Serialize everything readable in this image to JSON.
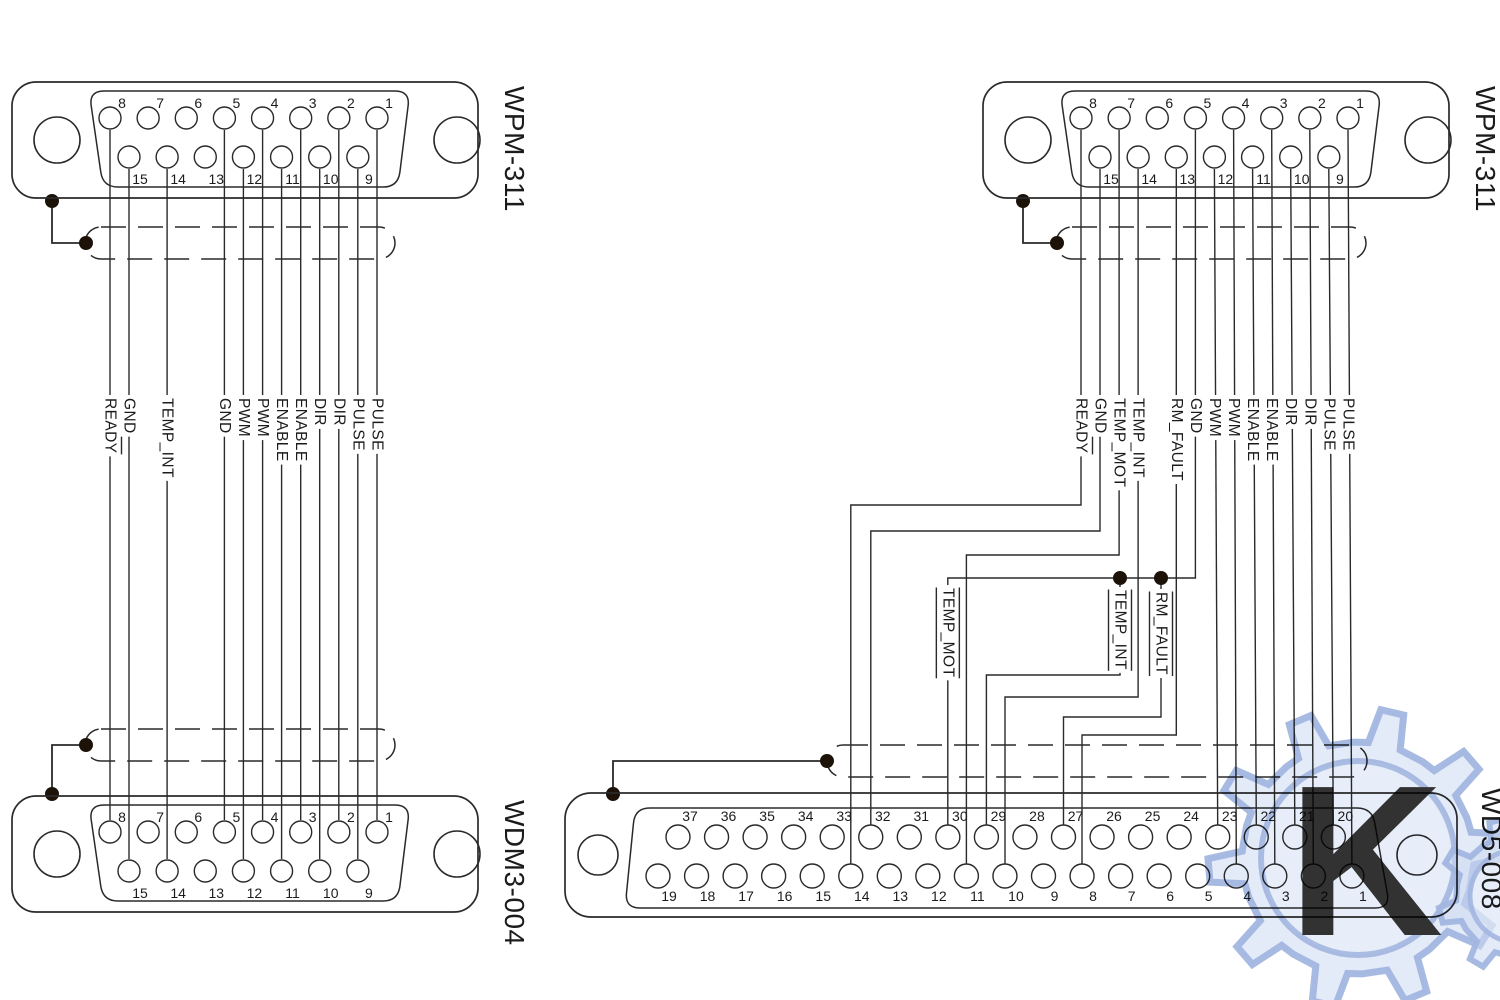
{
  "colors": {
    "line": "#2a2a2a",
    "background": "#ffffff",
    "watermark": "#a9bce3"
  },
  "connectors": {
    "top_left": {
      "label": "WPM-311",
      "type": "DB15",
      "pins_top": [
        "8",
        "7",
        "6",
        "5",
        "4",
        "3",
        "2",
        "1"
      ],
      "pins_bottom": [
        "15",
        "14",
        "13",
        "12",
        "11",
        "10",
        "9"
      ]
    },
    "top_right": {
      "label": "WPM-311",
      "type": "DB15",
      "pins_top": [
        "8",
        "7",
        "6",
        "5",
        "4",
        "3",
        "2",
        "1"
      ],
      "pins_bottom": [
        "15",
        "14",
        "13",
        "12",
        "11",
        "10",
        "9"
      ]
    },
    "bottom_left": {
      "label": "WDM3-004",
      "type": "DB15",
      "pins_top": [
        "8",
        "7",
        "6",
        "5",
        "4",
        "3",
        "2",
        "1"
      ],
      "pins_bottom": [
        "15",
        "14",
        "13",
        "12",
        "11",
        "10",
        "9"
      ]
    },
    "bottom_right": {
      "label": "WD5-008",
      "type": "DB37",
      "pins_top": [
        "37",
        "36",
        "35",
        "34",
        "33",
        "32",
        "31",
        "30",
        "29",
        "28",
        "27",
        "26",
        "25",
        "24",
        "23",
        "22",
        "21",
        "20"
      ],
      "pins_bottom": [
        "19",
        "18",
        "17",
        "16",
        "15",
        "14",
        "13",
        "12",
        "11",
        "10",
        "9",
        "8",
        "7",
        "6",
        "5",
        "4",
        "3",
        "2",
        "1"
      ]
    }
  },
  "left_cable": {
    "from_connector": "WPM-311",
    "to_connector": "WDM3-004",
    "shielded": true,
    "wires": [
      {
        "signal": "READY",
        "negated": true,
        "from_pin": "8",
        "to_pin": "8"
      },
      {
        "signal": "GND",
        "negated": false,
        "from_pin": "15",
        "to_pin": "15"
      },
      {
        "signal": "TEMP_INT",
        "negated": false,
        "from_pin": "14",
        "to_pin": "14"
      },
      {
        "signal": "GND",
        "negated": false,
        "from_pin": "5",
        "to_pin": "5"
      },
      {
        "signal": "PWM",
        "negated": true,
        "from_pin": "12",
        "to_pin": "12"
      },
      {
        "signal": "PWM",
        "negated": false,
        "from_pin": "4",
        "to_pin": "4"
      },
      {
        "signal": "ENABLE",
        "negated": true,
        "from_pin": "11",
        "to_pin": "11"
      },
      {
        "signal": "ENABLE",
        "negated": false,
        "from_pin": "3",
        "to_pin": "3"
      },
      {
        "signal": "DIR",
        "negated": true,
        "from_pin": "10",
        "to_pin": "10"
      },
      {
        "signal": "DIR",
        "negated": false,
        "from_pin": "2",
        "to_pin": "2"
      },
      {
        "signal": "PULSE",
        "negated": true,
        "from_pin": "9",
        "to_pin": "9"
      },
      {
        "signal": "PULSE",
        "negated": false,
        "from_pin": "1",
        "to_pin": "1"
      }
    ]
  },
  "right_cable": {
    "from_connector": "WPM-311",
    "to_connector": "WD5-008",
    "shielded": true,
    "wires": [
      {
        "signal": "READY",
        "negated": true,
        "from_pin": "8",
        "to_pin": "14"
      },
      {
        "signal": "GND",
        "negated": false,
        "from_pin": "15",
        "to_pin": "32"
      },
      {
        "signal": "TEMP_MOT",
        "negated": false,
        "from_pin": "7",
        "to_pin": "11"
      },
      {
        "signal": "TEMP_INT",
        "negated": false,
        "from_pin": "14",
        "to_pin": "10"
      },
      {
        "signal": "RM_FAULT",
        "negated": false,
        "from_pin": "13",
        "to_pin": "8"
      },
      {
        "signal": "GND",
        "negated": false,
        "from_pin": "5",
        "to_pin": "30"
      },
      {
        "signal": "PWM",
        "negated": true,
        "from_pin": "12",
        "to_pin": "23"
      },
      {
        "signal": "PWM",
        "negated": false,
        "from_pin": "4",
        "to_pin": "4"
      },
      {
        "signal": "ENABLE",
        "negated": true,
        "from_pin": "11",
        "to_pin": "22"
      },
      {
        "signal": "ENABLE",
        "negated": false,
        "from_pin": "3",
        "to_pin": "3"
      },
      {
        "signal": "DIR",
        "negated": true,
        "from_pin": "10",
        "to_pin": "21"
      },
      {
        "signal": "DIR",
        "negated": false,
        "from_pin": "2",
        "to_pin": "2"
      },
      {
        "signal": "PULSE",
        "negated": true,
        "from_pin": "9",
        "to_pin": "20"
      },
      {
        "signal": "PULSE",
        "negated": false,
        "from_pin": "1",
        "to_pin": "1"
      }
    ],
    "gnd_bus_labels": [
      {
        "signal": "TEMP_MOT",
        "negated": true,
        "to_pin": "30"
      },
      {
        "signal": "TEMP_INT",
        "negated": true,
        "to_pin": "29"
      },
      {
        "signal": "RM_FAULT",
        "negated": true,
        "to_pin": "27"
      }
    ]
  },
  "watermark": {
    "monogram": "K"
  }
}
